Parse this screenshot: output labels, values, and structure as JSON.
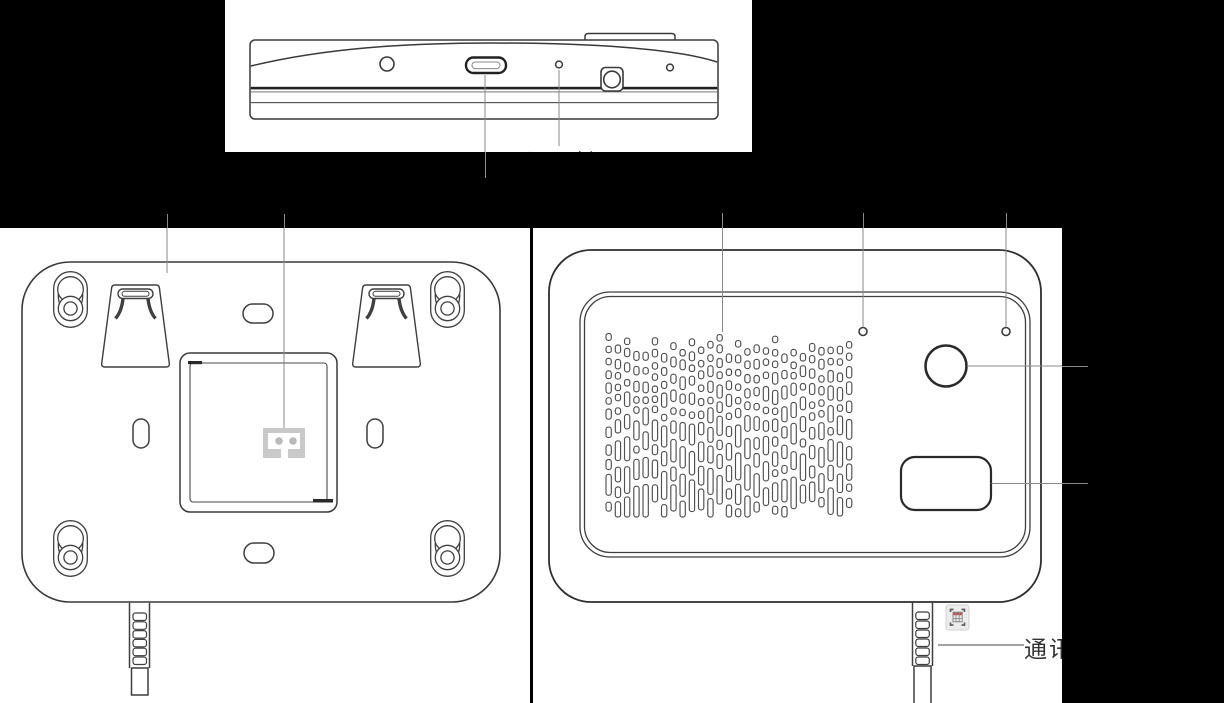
{
  "colors": {
    "background": "#000000",
    "panel": "#ffffff",
    "line": "#3a3a3a",
    "thick_line": "#222222",
    "leader": "#8a8a8a",
    "connector_gray": "#c9c9c9",
    "icon_red": "#c0504d"
  },
  "labels": {
    "settings_key": "设置键",
    "communication": "通讯"
  },
  "icons": {
    "scan_region": "scan-region-icon"
  }
}
